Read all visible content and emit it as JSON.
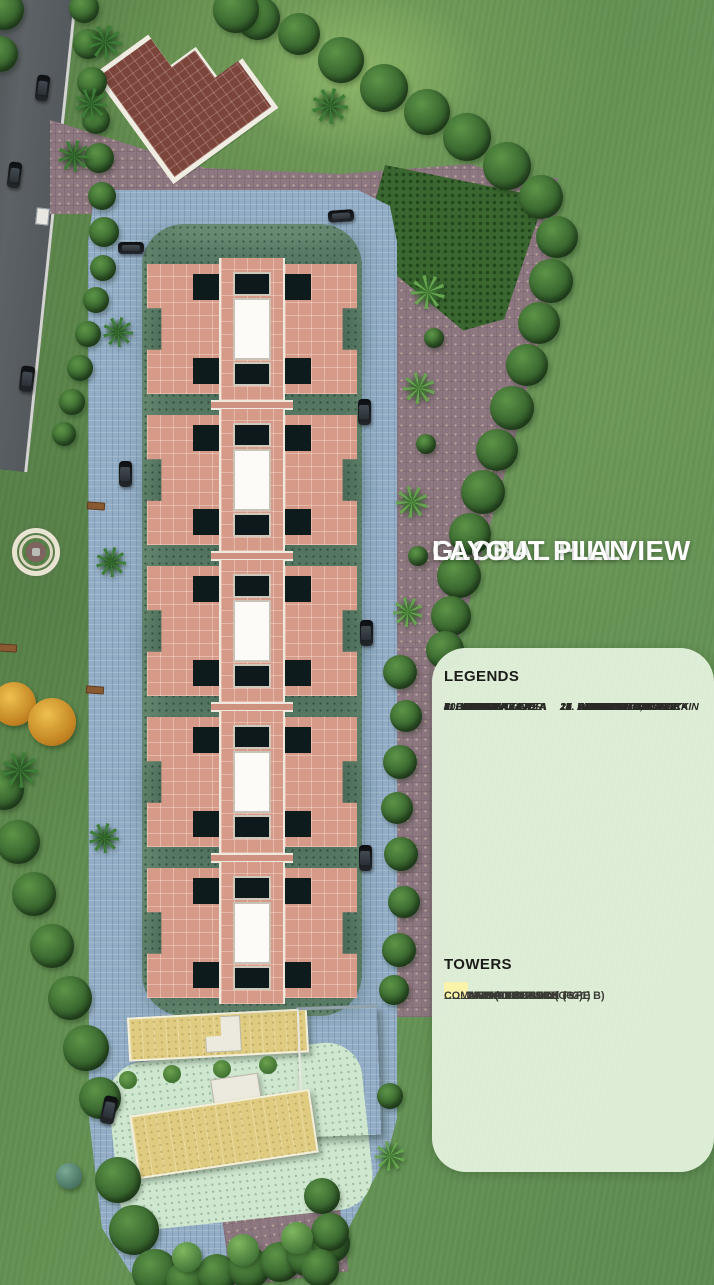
{
  "title": {
    "line1": "GLOBAL HILLVIEW",
    "line2": "LAYOUT PLAN"
  },
  "legend": {
    "heading": "LEGENDS",
    "items_left": [
      "1. GRASS MOUND",
      "2. PAVILION",
      "3. PALM PLAZA",
      "4. LAWN",
      "5. PERGOLA",
      "6. HEDGE",
      "7. PAVING",
      "8. PATH",
      "9. FOUNTAIN PLAZA",
      "10. AMPHITHEATER",
      "11. KIDS PLAY AREA"
    ],
    "items_right": [
      "12. GAZEBO & YOGA",
      "13. STEPPED GARDEN",
      "14. ART OBJECT",
      "15. PLANTING BED",
      "16. ROAD",
      "17. PARKING",
      "18. DROP OFF",
      "19. WATERFALL, FOUNTAIN",
      "20. SEAT",
      "21. STEPPED PLANTER",
      "22. COMMERCIAL BLOCK",
      "23. COMMUNITY BLOCK"
    ]
  },
  "towers": {
    "heading": "TOWERS",
    "entries": [
      {
        "color": "#f8cec5",
        "lines": [
          "BLOCK-1 (TYPE A and TYPE B)",
          "STILT +19 FLOORS"
        ]
      },
      {
        "color": "#c69a52",
        "lines": [
          "COMMUNITY CENTRE"
        ]
      },
      {
        "color": "#fcc60e",
        "lines": [
          "ANGANWADI / CRECH",
          "GROUND FLOOR"
        ]
      },
      {
        "color": "#ee8166",
        "lines": [
          "COMMERCIAL BLOCK (G+1)"
        ]
      },
      {
        "color": "#faf4ab",
        "lines": [
          "COMMUNITY BLOCK (G+2)"
        ]
      }
    ]
  },
  "colors": {
    "panel_bg": "#e1efda",
    "title_text": "#ffffff",
    "tower_roof": "#d69a88",
    "podium_paving": "#92adc5",
    "stilt_garden": "#7fa186",
    "parking_paving": "#8d7780",
    "grass": "#628e50"
  }
}
